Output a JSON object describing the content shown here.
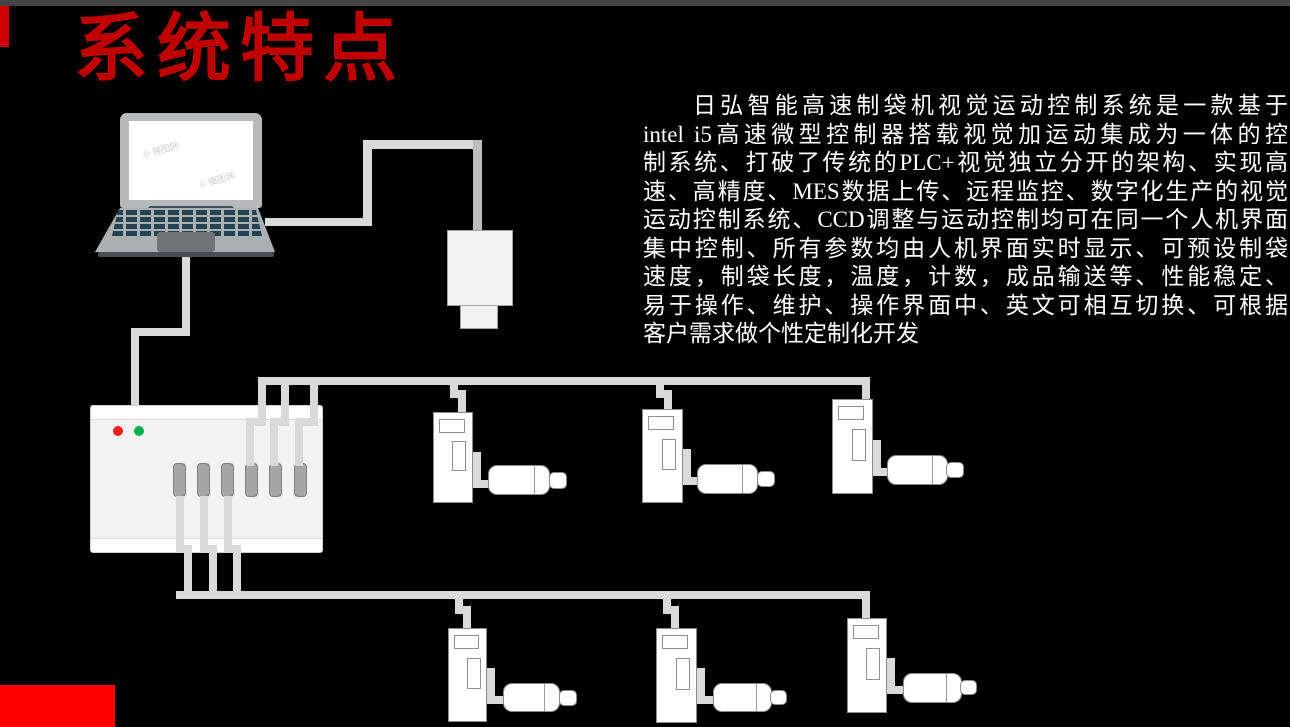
{
  "slide": {
    "title": "系统特点",
    "title_color": "#C00000",
    "background_color": "#000000",
    "top_bar_color": "#454545",
    "corner_accent_color": "#D00000",
    "bottom_accent_color": "#FF0000"
  },
  "description": {
    "text_color": "#FFFFFF",
    "lines": [
      "日弘智能高速制袋机视觉运动控制系统是一款基于",
      "intel i5高速微型控制器搭载视觉加运动集成为一体的控",
      "制系统、打破了传统的PLC+视觉独立分开的架构、实现高",
      "速、高精度、MES数据上传、远程监控、数字化生产的视觉",
      "运动控制系统、CCD调整与运动控制均可在同一个人机界面",
      "集中控制、所有参数均由人机界面实时显示、可预设制袋",
      "速度，制袋长度，温度，计数，成品输送等、性能稳定、",
      "易于操作、维护、操作界面中、英文可相互切换、可根据",
      "客户需求做个性定制化开发"
    ],
    "full_text": "日弘智能高速制袋机视觉运动控制系统是一款基于intel i5高速微型控制器搭载视觉加运动集成为一体的控制系统、打破了传统的PLC+视觉独立分开的架构、实现高速、高精度、MES数据上传、远程监控、数字化生产的视觉运动控制系统、CCD调整与运动控制均可在同一个人机界面集中控制、所有参数均由人机界面实时显示、可预设制袋速度，制袋长度，温度，计数，成品输送等、性能稳定、易于操作、维护、操作界面中、英文可相互切换、可根据客户需求做个性定制化开发"
  },
  "watermark": {
    "text": "© 摄图网"
  },
  "diagram": {
    "cable_color": "#D9D9D9",
    "cable_color_dark": "#BDBDBD",
    "device_fill": "#FFFFFF",
    "device_border": "#8C8C8C",
    "controller": {
      "fill": "#F2F2F2",
      "led_colors": [
        "#FF1A1A",
        "#00B050"
      ],
      "port_fill": "#A6A6A6",
      "port_xs": [
        82,
        106,
        130,
        154,
        178,
        203
      ]
    },
    "cables": [
      {
        "x": 265,
        "y": 218,
        "w": 106,
        "h": 8
      },
      {
        "x": 363,
        "y": 140,
        "w": 9,
        "h": 86
      },
      {
        "x": 363,
        "y": 140,
        "w": 119,
        "h": 9
      },
      {
        "x": 473,
        "y": 140,
        "w": 9,
        "h": 91,
        "dark": true
      },
      {
        "x": 182,
        "y": 252,
        "w": 8,
        "h": 84
      },
      {
        "x": 131,
        "y": 328,
        "w": 59,
        "h": 8
      },
      {
        "x": 131,
        "y": 328,
        "w": 8,
        "h": 77
      },
      {
        "x": 246,
        "y": 426,
        "w": 8,
        "h": 40
      },
      {
        "x": 246,
        "y": 418,
        "w": 20,
        "h": 8
      },
      {
        "x": 258,
        "y": 379,
        "w": 8,
        "h": 47
      },
      {
        "x": 270,
        "y": 426,
        "w": 8,
        "h": 40
      },
      {
        "x": 270,
        "y": 418,
        "w": 19,
        "h": 8
      },
      {
        "x": 281,
        "y": 379,
        "w": 8,
        "h": 47
      },
      {
        "x": 295,
        "y": 426,
        "w": 8,
        "h": 40
      },
      {
        "x": 295,
        "y": 418,
        "w": 23,
        "h": 8
      },
      {
        "x": 310,
        "y": 379,
        "w": 8,
        "h": 47
      },
      {
        "x": 258,
        "y": 377,
        "w": 612,
        "h": 8
      },
      {
        "x": 450,
        "y": 385,
        "w": 8,
        "h": 13
      },
      {
        "x": 450,
        "y": 390,
        "w": 16,
        "h": 8
      },
      {
        "x": 458,
        "y": 390,
        "w": 8,
        "h": 24
      },
      {
        "x": 656,
        "y": 385,
        "w": 8,
        "h": 13
      },
      {
        "x": 656,
        "y": 390,
        "w": 16,
        "h": 8
      },
      {
        "x": 664,
        "y": 390,
        "w": 8,
        "h": 21
      },
      {
        "x": 862,
        "y": 377,
        "w": 8,
        "h": 24
      },
      {
        "x": 176,
        "y": 496,
        "w": 8,
        "h": 57
      },
      {
        "x": 176,
        "y": 545,
        "w": 16,
        "h": 8
      },
      {
        "x": 184,
        "y": 545,
        "w": 8,
        "h": 54
      },
      {
        "x": 200,
        "y": 496,
        "w": 8,
        "h": 57
      },
      {
        "x": 200,
        "y": 545,
        "w": 17,
        "h": 8
      },
      {
        "x": 209,
        "y": 545,
        "w": 8,
        "h": 54
      },
      {
        "x": 224,
        "y": 496,
        "w": 8,
        "h": 57
      },
      {
        "x": 224,
        "y": 545,
        "w": 17,
        "h": 8
      },
      {
        "x": 233,
        "y": 545,
        "w": 8,
        "h": 54
      },
      {
        "x": 176,
        "y": 591,
        "w": 694,
        "h": 8
      },
      {
        "x": 455,
        "y": 599,
        "w": 8,
        "h": 15
      },
      {
        "x": 455,
        "y": 606,
        "w": 16,
        "h": 8
      },
      {
        "x": 463,
        "y": 606,
        "w": 8,
        "h": 23
      },
      {
        "x": 663,
        "y": 599,
        "w": 8,
        "h": 15
      },
      {
        "x": 663,
        "y": 606,
        "w": 16,
        "h": 8
      },
      {
        "x": 671,
        "y": 606,
        "w": 8,
        "h": 23
      },
      {
        "x": 862,
        "y": 591,
        "w": 8,
        "h": 28
      },
      {
        "x": 473,
        "y": 452,
        "w": 8,
        "h": 36
      },
      {
        "x": 473,
        "y": 480,
        "w": 18,
        "h": 8
      },
      {
        "x": 683,
        "y": 449,
        "w": 8,
        "h": 36
      },
      {
        "x": 683,
        "y": 477,
        "w": 18,
        "h": 8
      },
      {
        "x": 873,
        "y": 440,
        "w": 8,
        "h": 36
      },
      {
        "x": 873,
        "y": 468,
        "w": 18,
        "h": 8
      },
      {
        "x": 487,
        "y": 668,
        "w": 8,
        "h": 36
      },
      {
        "x": 487,
        "y": 696,
        "w": 18,
        "h": 8
      },
      {
        "x": 697,
        "y": 668,
        "w": 8,
        "h": 36
      },
      {
        "x": 697,
        "y": 696,
        "w": 18,
        "h": 8
      },
      {
        "x": 887,
        "y": 658,
        "w": 8,
        "h": 36
      },
      {
        "x": 887,
        "y": 686,
        "w": 18,
        "h": 8
      }
    ],
    "devices": [
      {
        "drive": {
          "x": 433,
          "y": 412,
          "w": 40,
          "h": 91
        },
        "motor": {
          "x": 488,
          "y": 465,
          "w": 62,
          "h": 30
        },
        "shaft": {
          "x": 549,
          "y": 472,
          "w": 18,
          "h": 17
        }
      },
      {
        "drive": {
          "x": 642,
          "y": 409,
          "w": 41,
          "h": 94
        },
        "motor": {
          "x": 697,
          "y": 464,
          "w": 61,
          "h": 30
        },
        "shaft": {
          "x": 757,
          "y": 471,
          "w": 18,
          "h": 16
        }
      },
      {
        "drive": {
          "x": 832,
          "y": 399,
          "w": 41,
          "h": 95
        },
        "motor": {
          "x": 887,
          "y": 455,
          "w": 61,
          "h": 30
        },
        "shaft": {
          "x": 946,
          "y": 462,
          "w": 18,
          "h": 16
        }
      },
      {
        "drive": {
          "x": 448,
          "y": 628,
          "w": 39,
          "h": 94
        },
        "motor": {
          "x": 503,
          "y": 683,
          "w": 57,
          "h": 29
        },
        "shaft": {
          "x": 559,
          "y": 690,
          "w": 18,
          "h": 16
        }
      },
      {
        "drive": {
          "x": 656,
          "y": 628,
          "w": 41,
          "h": 95
        },
        "motor": {
          "x": 713,
          "y": 683,
          "w": 59,
          "h": 29
        },
        "shaft": {
          "x": 770,
          "y": 690,
          "w": 17,
          "h": 15
        }
      },
      {
        "drive": {
          "x": 847,
          "y": 618,
          "w": 40,
          "h": 95
        },
        "motor": {
          "x": 903,
          "y": 673,
          "w": 59,
          "h": 30
        },
        "shaft": {
          "x": 960,
          "y": 680,
          "w": 17,
          "h": 15
        }
      }
    ]
  }
}
